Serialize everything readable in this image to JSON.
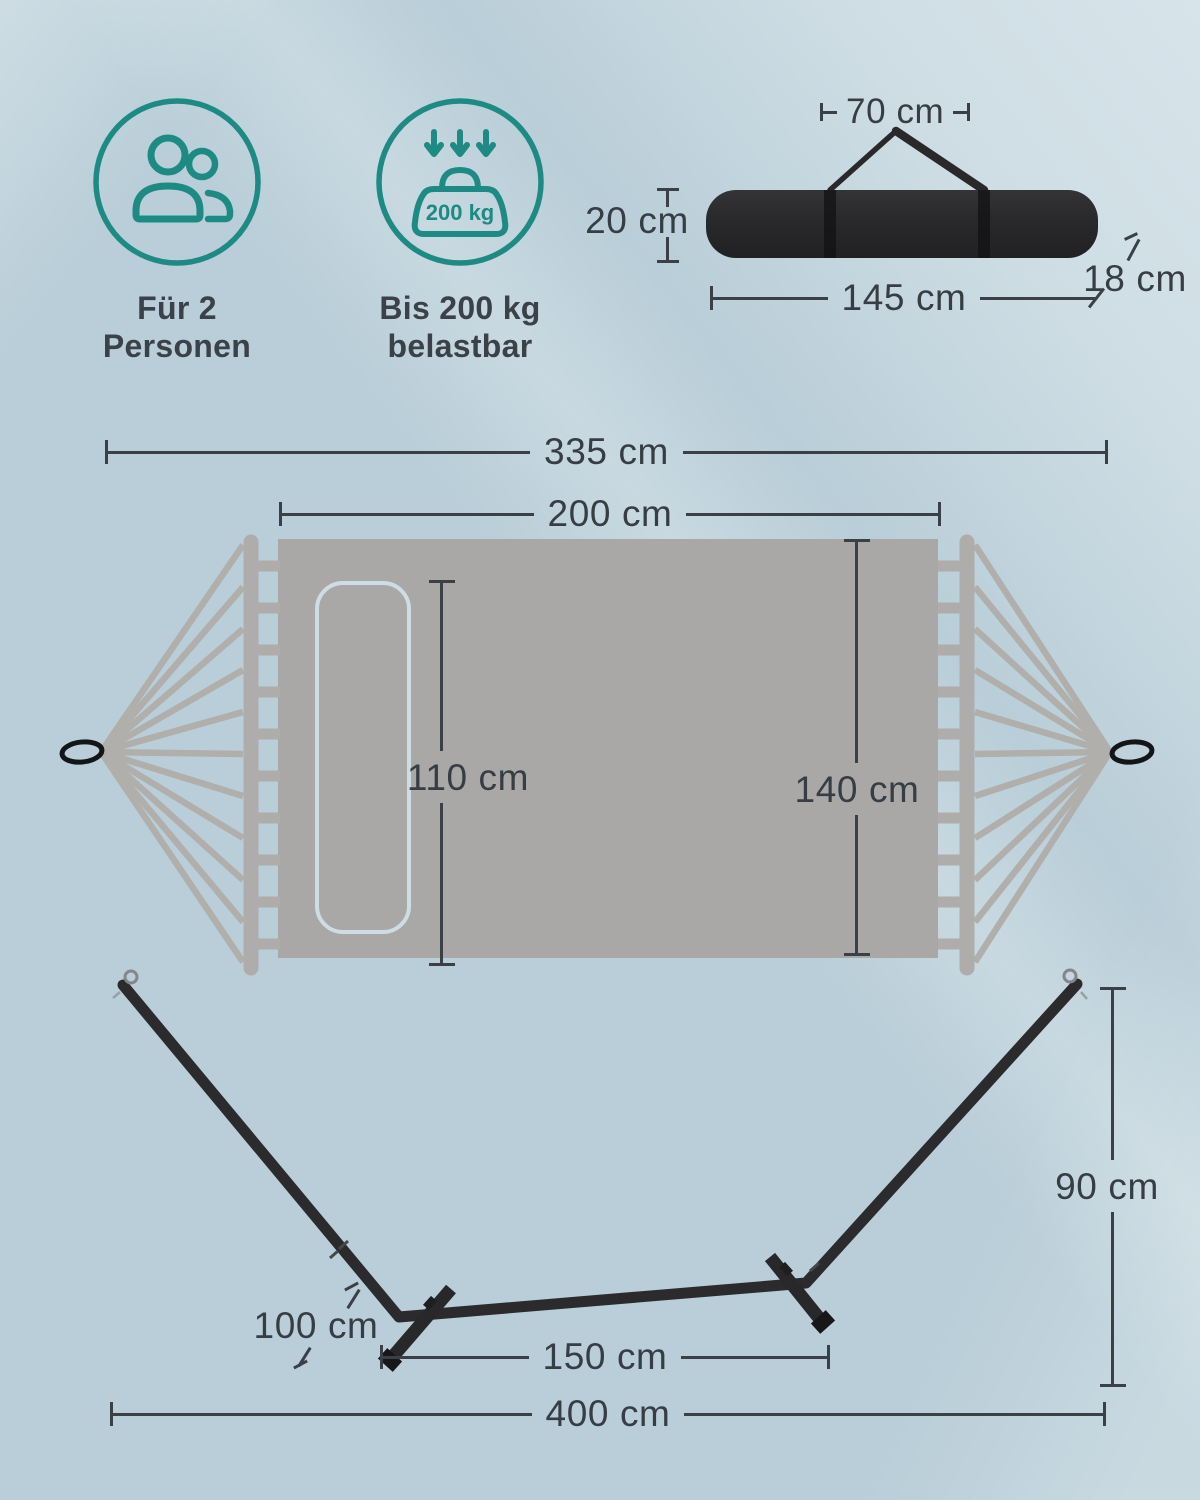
{
  "features": [
    {
      "caption": "Für 2\nPersonen"
    },
    {
      "caption": "Bis 200 kg\nbelastbar",
      "badge_label": "200 kg"
    }
  ],
  "dims": {
    "bag_strap": "70 cm",
    "bag_height": "20 cm",
    "bag_length": "145 cm",
    "bag_depth": "18 cm",
    "total_length": "335 cm",
    "fabric_length": "200 cm",
    "pillow_length": "110 cm",
    "fabric_width": "140 cm",
    "stand_height": "90 cm",
    "foot_length": "100 cm",
    "feet_distance": "150 cm",
    "stand_length": "400 cm"
  },
  "colors": {
    "background": "#b9ced8",
    "accent_teal": "#1d8a84",
    "fabric_gray": "#a9a8a6",
    "metal_black": "#2b2b2d",
    "dimension_line": "#3a4046",
    "text": "#373d44"
  }
}
